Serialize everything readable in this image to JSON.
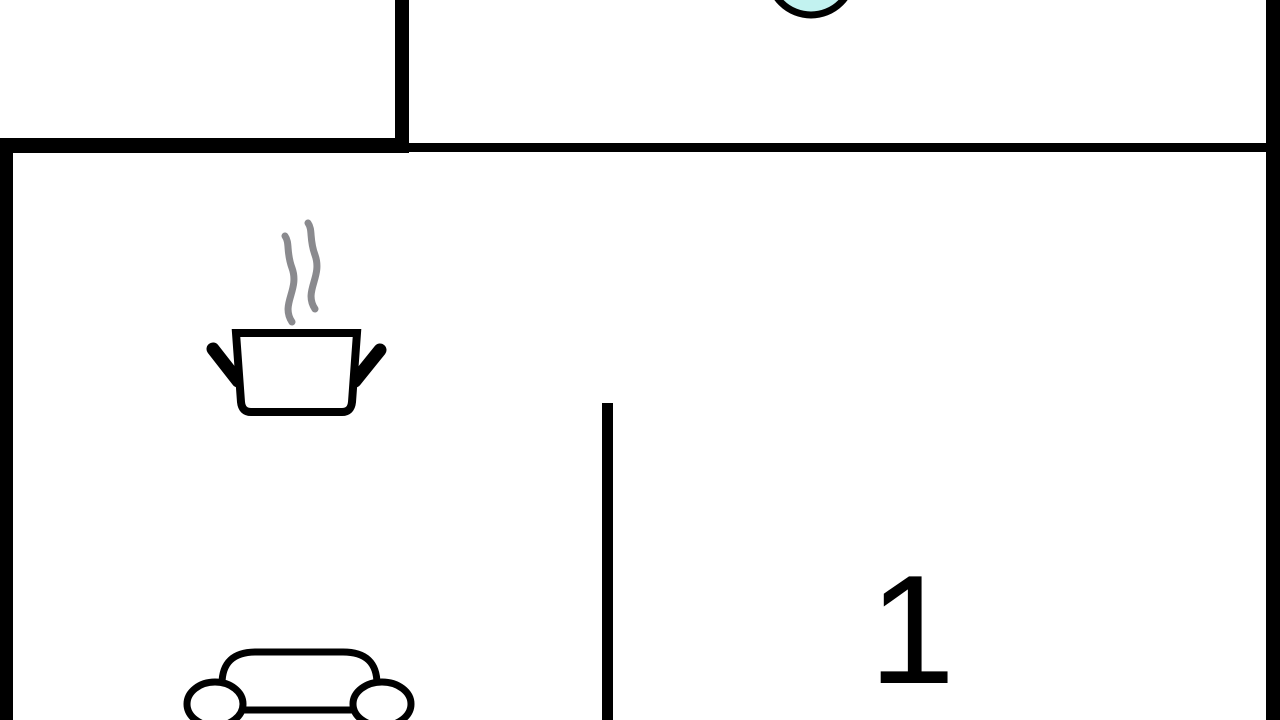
{
  "floorplan": {
    "background_color": "#ffffff",
    "wall_color": "#000000",
    "label_color": "#000000",
    "rooms": [
      {
        "label": "1"
      }
    ],
    "fixtures": {
      "circle": {
        "icon": "round-basin-icon",
        "fill": "#c2f2f0",
        "stroke": "#000000"
      },
      "pot": {
        "icon": "steam-pot-icon",
        "outline": "#000000",
        "fill": "#ffffff",
        "steam_color": "#8a8a8e"
      },
      "car": {
        "icon": "car-icon",
        "outline": "#000000",
        "fill": "#ffffff"
      }
    }
  }
}
